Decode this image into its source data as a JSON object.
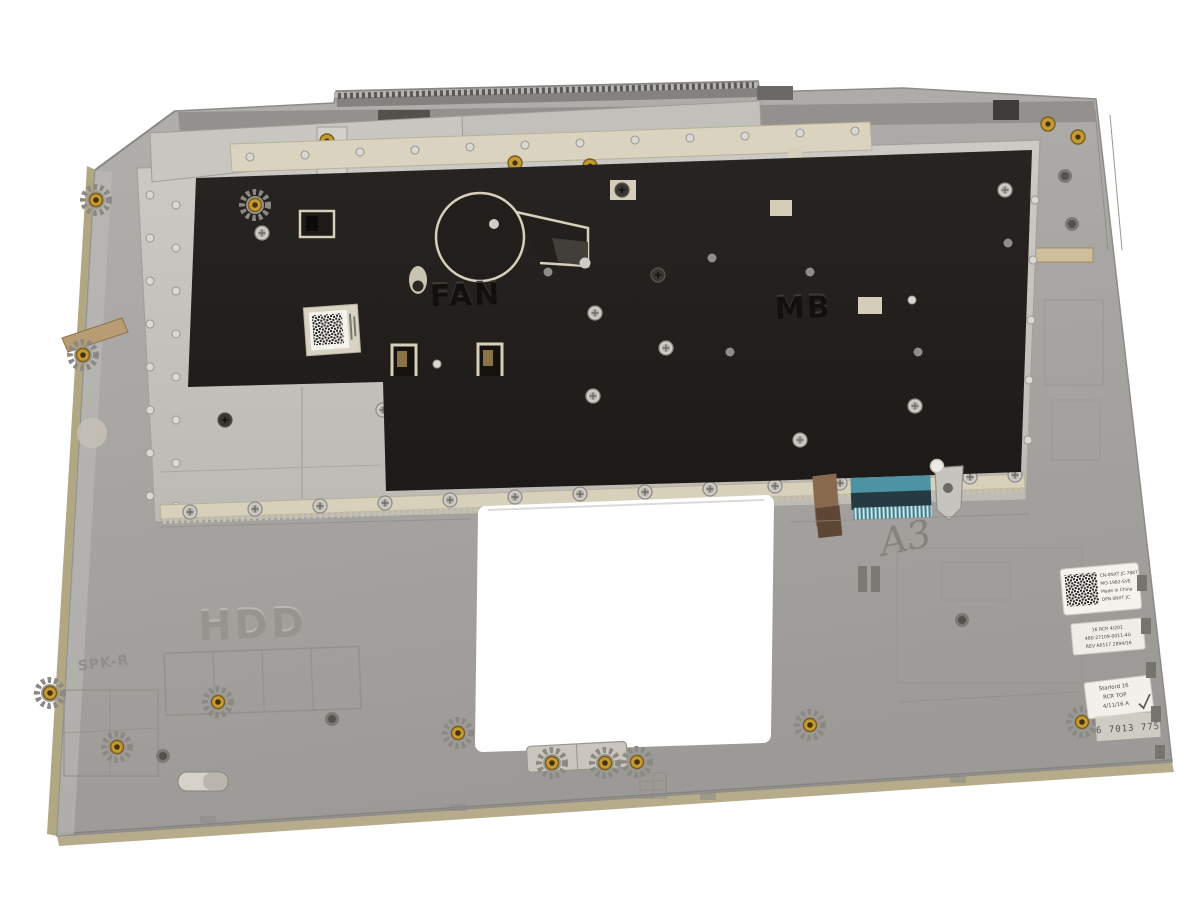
{
  "meta": {
    "description": "Product photo: inside view of a gray laptop palmrest keyboard assembly on a white background, with black keyboard shield plate, metal backing plate, ribbon-cable connector, touchpad cutout and service labels"
  },
  "embossed_labels": {
    "hdd": "HDD",
    "fan": "FAN",
    "mb": "MB",
    "speaker_right": "SPK-R"
  },
  "handwritten_mark": "A3",
  "stickers": {
    "service_label": {
      "lines": [
        "CN-0NXT JC-7887",
        "MO-1982-SVE",
        "Made in China",
        "DPN 0NXT JC"
      ]
    },
    "part_number_label": {
      "lines": [
        "16 RCR 4/201",
        "480-27109-0011-4G",
        "REV A0117 2894/16"
      ]
    },
    "qc_label": {
      "lines": [
        "Starlord 16",
        "RCR TOP",
        "4/11/16 A"
      ]
    },
    "ink_stamp": "6 7013 775"
  },
  "colors": {
    "background": "#ffffff",
    "body_gray": "#a7a5a1",
    "shield_black": "#221f1c",
    "plate_silver": "#c7c5c0",
    "flange_cream": "#d7d1bc",
    "edge_tan": "#b3a887",
    "cable_teal": "#4e93a4",
    "cable_brown": "#8a6a4e",
    "brass": "#c49a33",
    "label_white": "#f4f2ec"
  }
}
